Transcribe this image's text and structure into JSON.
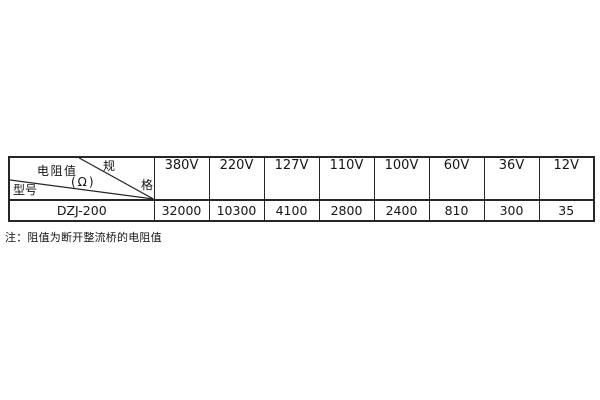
{
  "window": {
    "background": "#ffffff"
  },
  "table": {
    "corner": {
      "spec_top_char": "规",
      "spec_bottom_char": "格",
      "resistance_label": "电阻值",
      "resistance_unit": "(Ω)",
      "model_label": "型号"
    },
    "voltage_columns": [
      "380V",
      "220V",
      "127V",
      "110V",
      "100V",
      "60V",
      "36V",
      "12V"
    ],
    "rows": [
      {
        "model": "DZJ-200",
        "values": [
          "32000",
          "10300",
          "4100",
          "2800",
          "2400",
          "810",
          "300",
          "35"
        ]
      }
    ]
  },
  "note": "注：阻值为断开整流桥的电阻值",
  "colors": {
    "border": "#262626",
    "text": "#151515",
    "background": "#ffffff"
  }
}
